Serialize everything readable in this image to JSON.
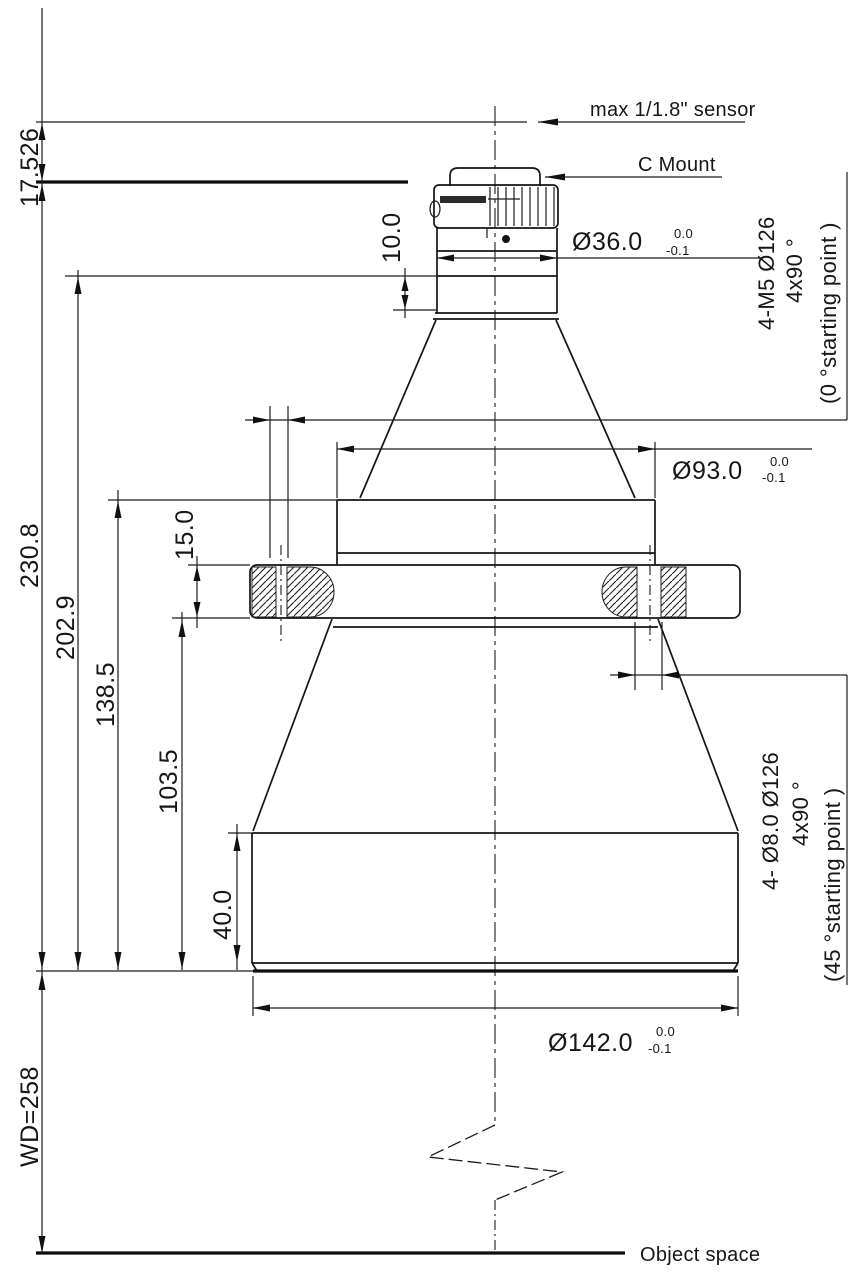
{
  "labels": {
    "sensor": "max 1/1.8\" sensor",
    "c_mount": "C Mount",
    "object_space": "Object space"
  },
  "dimensions": {
    "sensor_to_flange": "17.526",
    "flange_to_front": "230.8",
    "focus_ref_to_front": "202.9",
    "shoulder_to_front": "138.5",
    "flange_bottom_to_front": "103.5",
    "flange_thickness": "15.0",
    "barrel_straight": "40.0",
    "focus_section": "10.0",
    "working_distance": "WD=258",
    "dia36": "Ø36.0",
    "dia93": "Ø93.0",
    "dia142": "Ø142.0",
    "tol_upper": "0.0",
    "tol_lower": "-0.1"
  },
  "notes": {
    "m5_line1": "4-M5  Ø126",
    "m5_line2": "4x90 °",
    "m5_line3": "(0 °starting point )",
    "d8_line1": "4- Ø8.0  Ø126",
    "d8_line2": "4x90 °",
    "d8_line3": "(45 °starting point )"
  },
  "colors": {
    "line": "#1c1c1c",
    "background": "#ffffff"
  }
}
